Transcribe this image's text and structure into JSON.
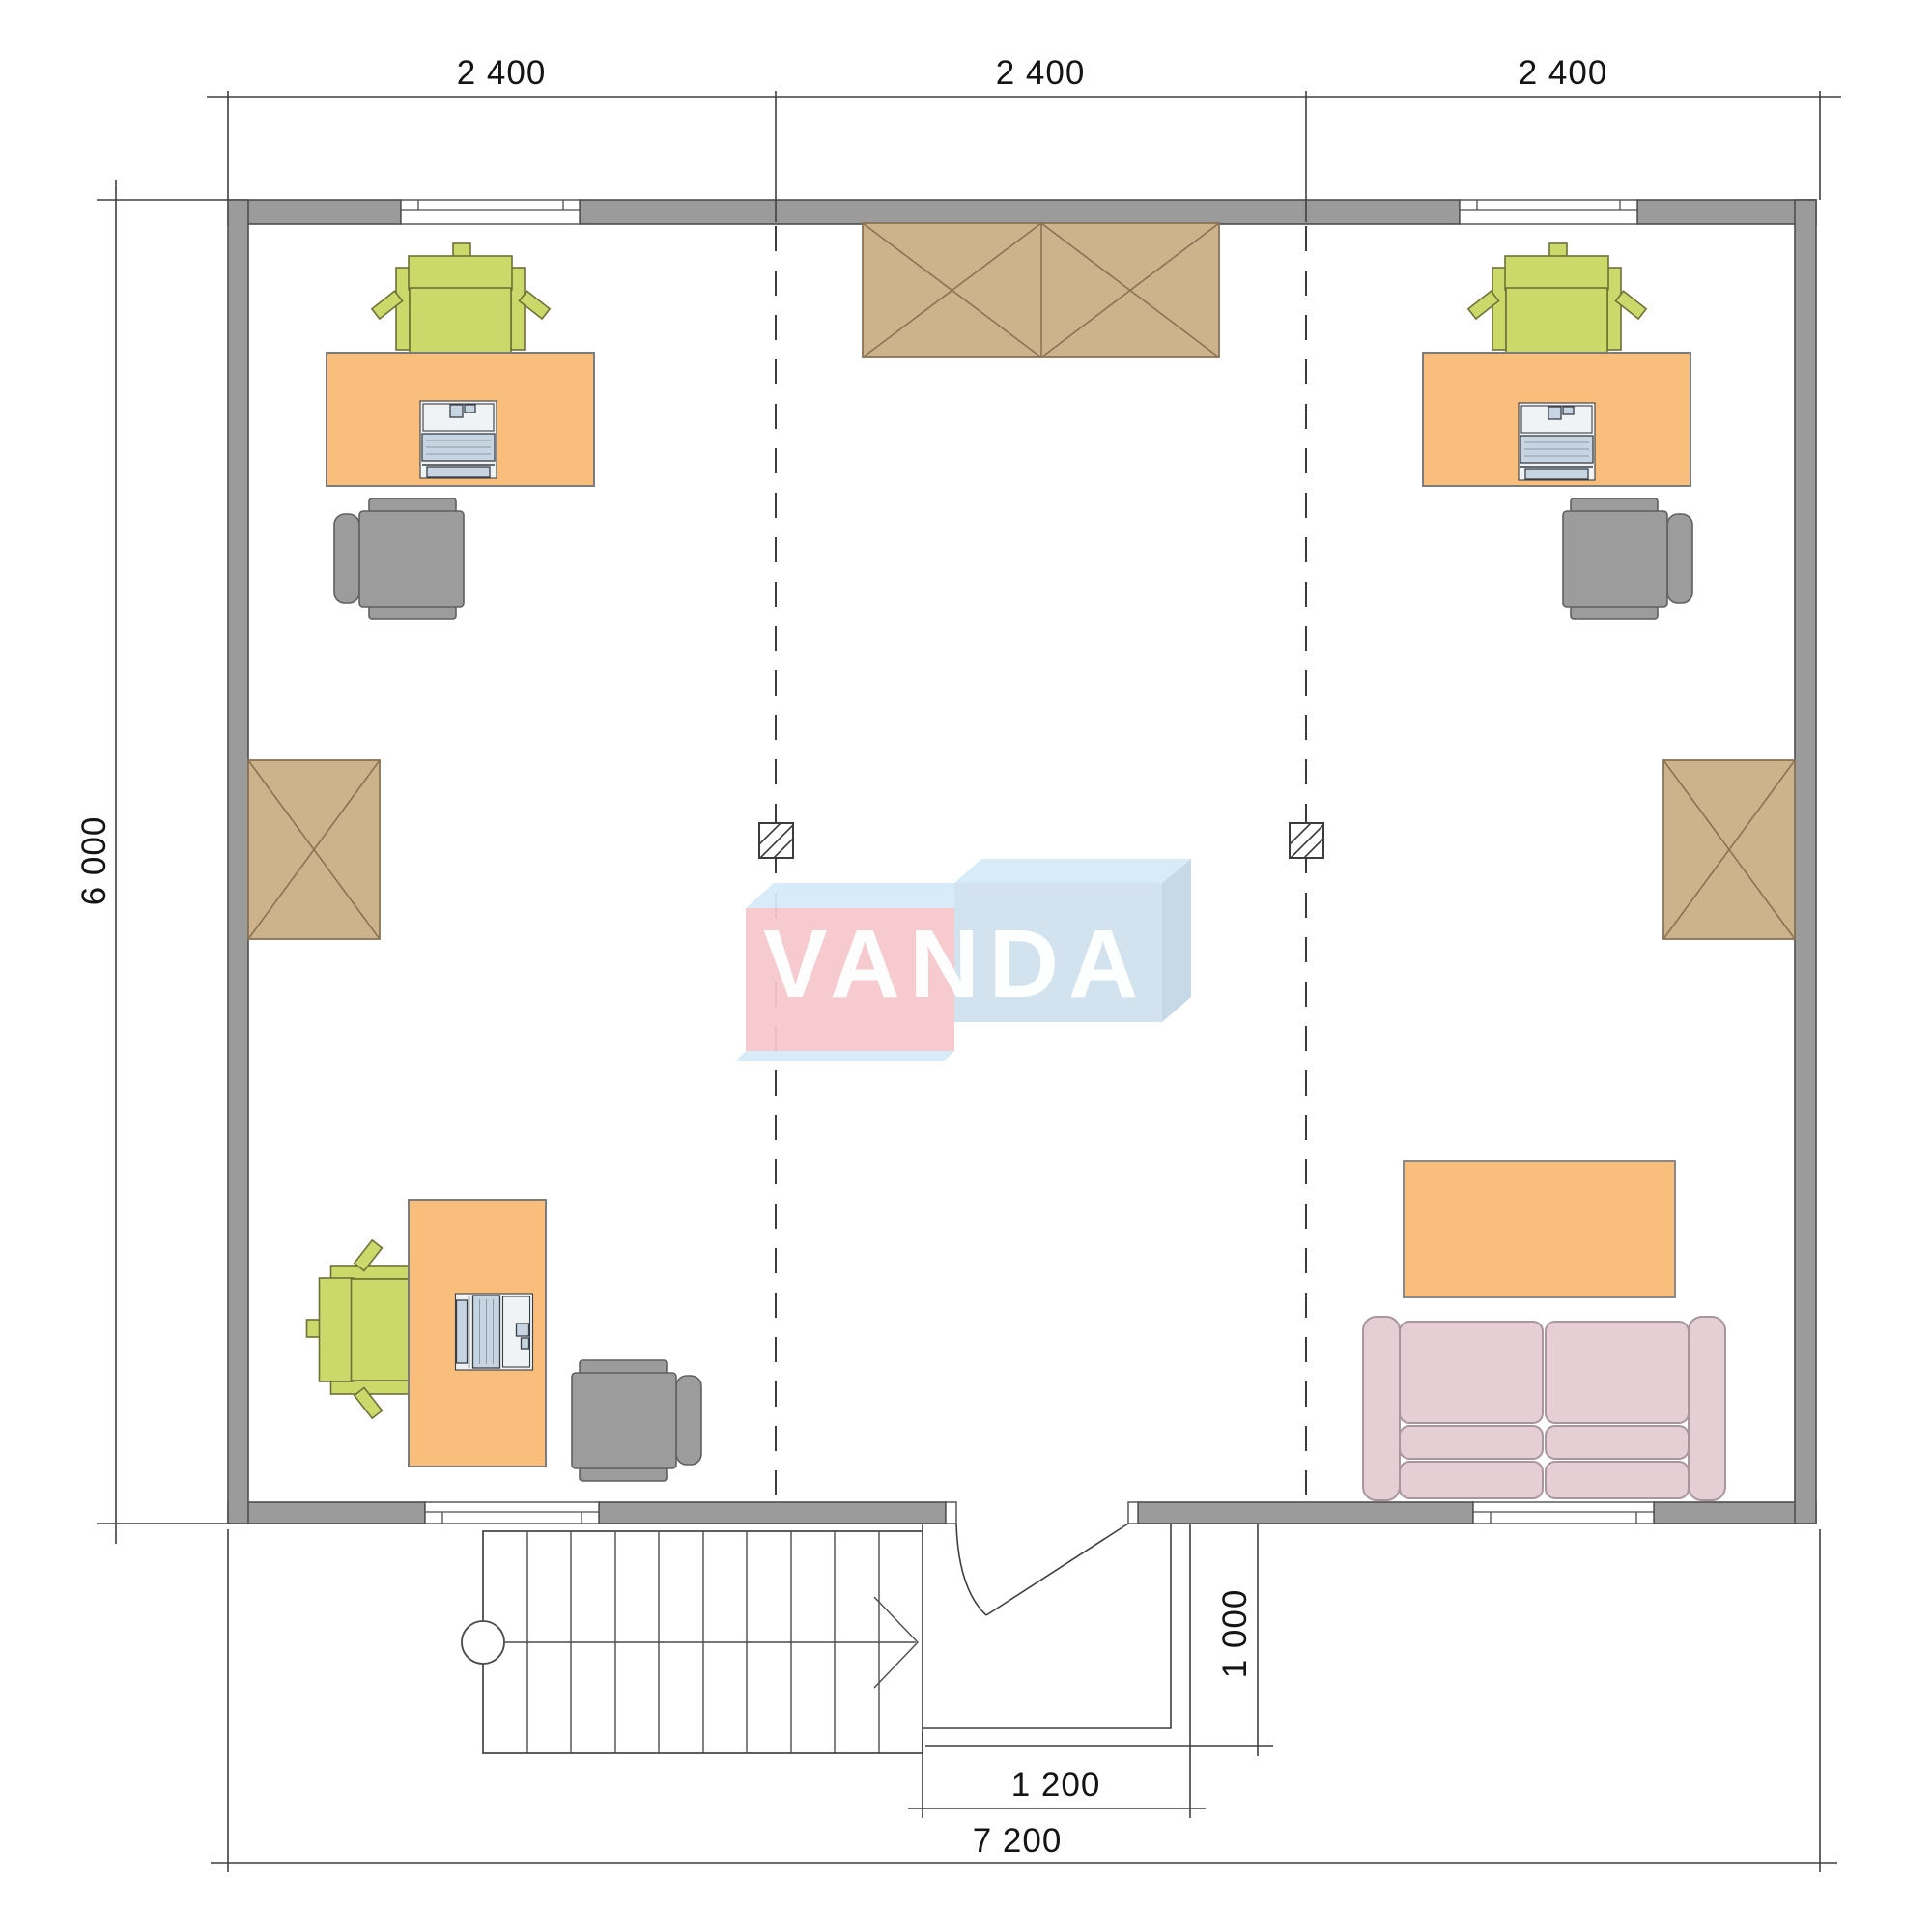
{
  "watermark": {
    "text": "VANDA"
  },
  "dimensions": {
    "top_segments": [
      "2 400",
      "2 400",
      "2 400"
    ],
    "side_height": "6 000",
    "entry_depth": "1 000",
    "entry_width": "1 200",
    "total_width": "7 200"
  },
  "colors": {
    "wall": "#9b9b9b",
    "wallLine": "#4e4e4e",
    "line": "#3f3f3f",
    "dimText": "#141414",
    "desk": "#f9be7c",
    "deskLine": "#7c7c7c",
    "chair": "#cbd96b",
    "chairLine": "#6f7038",
    "grayChair": "#9c9c9c",
    "grayChairLine": "#5f5f5f",
    "cabinet": "#cdb38b",
    "cabinetLine": "#8a7355",
    "sofa": "#e5cfd4",
    "sofaLine": "#a8959d",
    "laptopBody": "#f0f3f6",
    "laptopScreen": "#c7d5e2",
    "logoPink": "#f6c6cb",
    "logoBlueTop": "#d6eaf8",
    "logoBlueFront": "#cfe0ee",
    "logoBlueSide": "#c3d6e6",
    "logoText": "#ffffff"
  }
}
